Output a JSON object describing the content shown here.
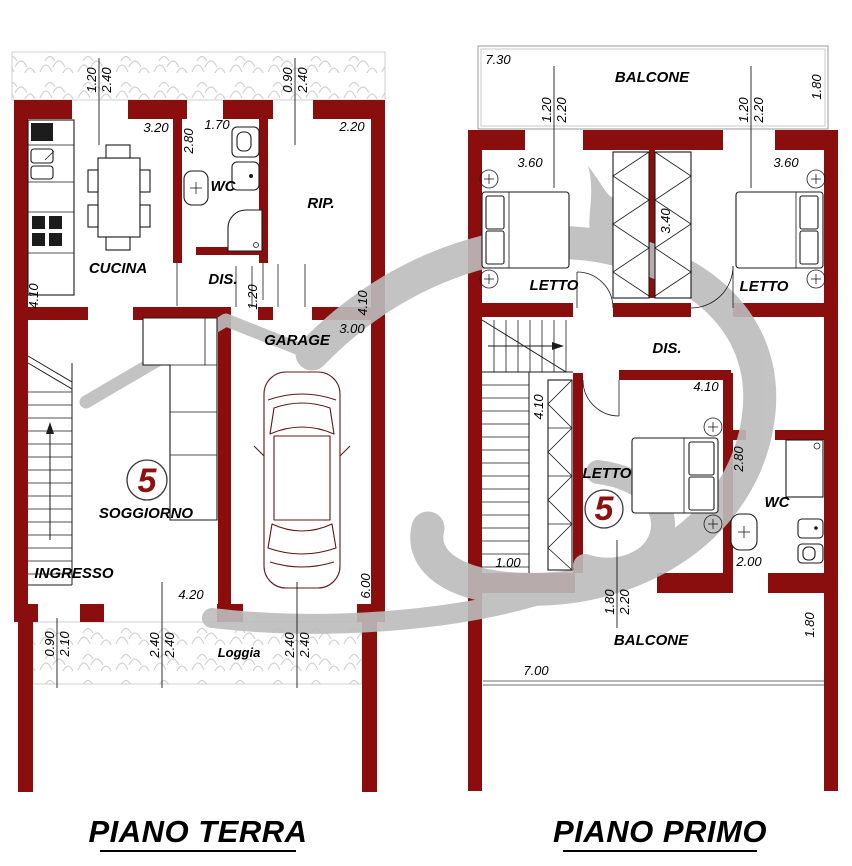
{
  "colors": {
    "wall": "#8a0e0e",
    "unit_accent": "#8e1111",
    "watermark": "#bcbcbc",
    "hatch_stroke": "#d2d2d2"
  },
  "piano_terra": {
    "title": "PIANO TERRA",
    "labels": {
      "cucina": "CUCINA",
      "wc": "WC",
      "rip": "RIP.",
      "dis": "DIS.",
      "garage": "GARAGE",
      "soggiorno": "SOGGIORNO",
      "ingresso": "INGRESSO",
      "loggia": "Loggia",
      "unit": "5"
    },
    "dims": {
      "win_left_w": "1.20",
      "win_left_h": "2.40",
      "win_right_w": "0.90",
      "win_right_h": "2.40",
      "cucina_w": "3.20",
      "wc_h": "2.80",
      "wc_w": "1.70",
      "rip_w": "2.20",
      "left_side_h": "4.10",
      "right_side_h": "4.10",
      "garage_w": "3.00",
      "dis_door_w": "1.20",
      "soggiorno_w": "4.20",
      "garage_h": "6.00",
      "entry_w": "0.90",
      "entry_h": "2.10",
      "loggia_door1_w": "2.40",
      "loggia_door1_h": "2.40",
      "loggia_door2_w": "2.40",
      "loggia_door2_h": "2.40"
    }
  },
  "piano_primo": {
    "title": "PIANO PRIMO",
    "labels": {
      "balcone_top": "BALCONE",
      "letto_left": "LETTO",
      "letto_right": "LETTO",
      "dis": "DIS.",
      "letto_bottom": "LETTO",
      "wc": "WC",
      "balcone_bottom": "BALCONE",
      "unit": "5"
    },
    "dims": {
      "balcone_top_w": "7.30",
      "balcone_top_d": "1.80",
      "win_left_w": "1.20",
      "win_left_h": "2.20",
      "win_right_w": "1.20",
      "win_right_h": "2.20",
      "letto_left_w": "3.60",
      "letto_right_w": "3.60",
      "wardrobe_h": "3.40",
      "letto_bottom_w": "4.10",
      "wardrobe2_h": "4.10",
      "wc_h": "2.80",
      "hall_w": "1.00",
      "wc_w": "2.00",
      "balc_door_w": "1.80",
      "balc_door_h": "2.20",
      "balcone_bottom_w": "7.00",
      "balcone_bottom_d": "1.80"
    }
  }
}
